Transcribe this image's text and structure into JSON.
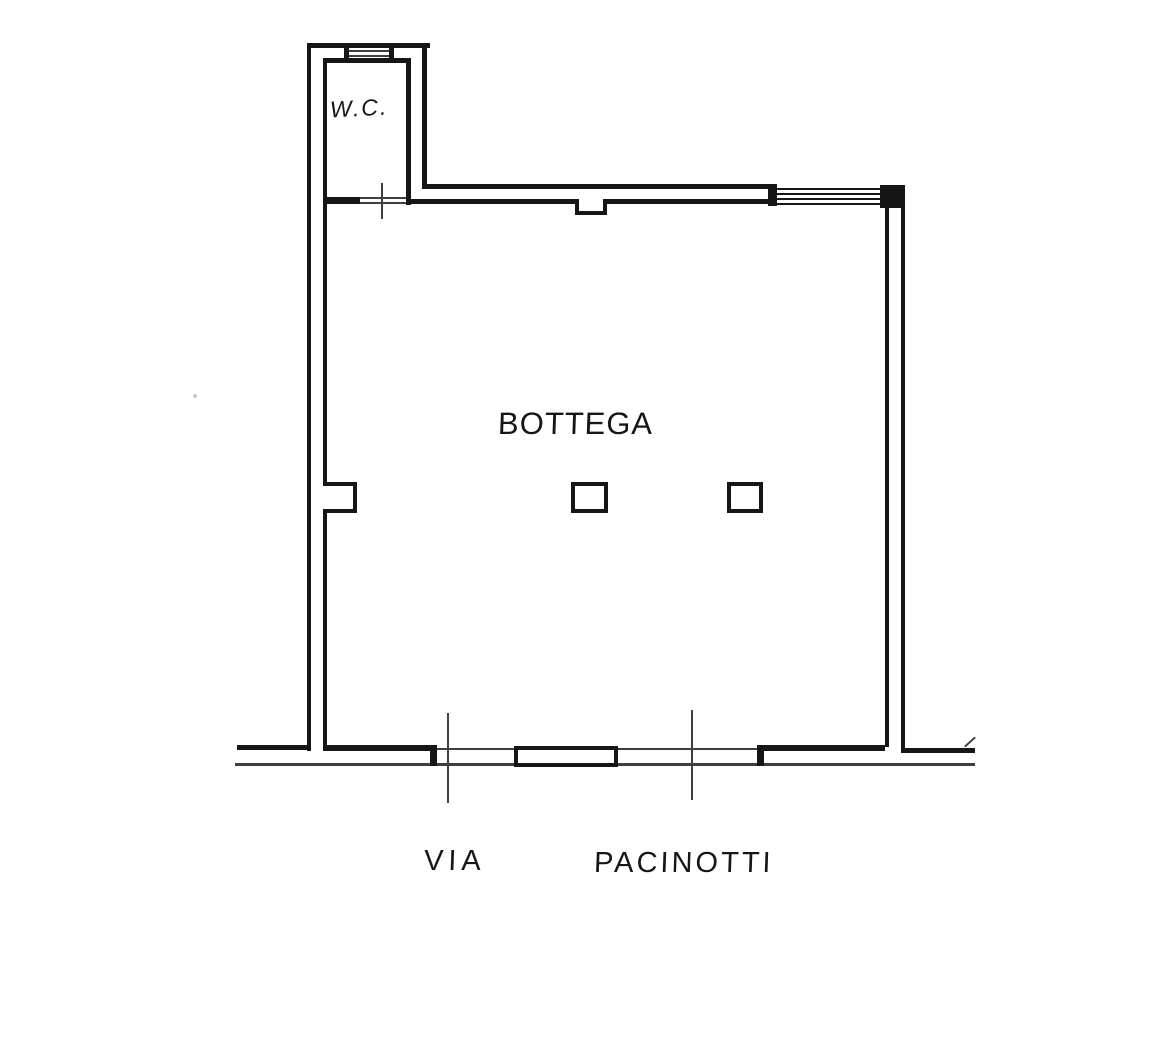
{
  "colors": {
    "ink": "#161616",
    "paper": "#ffffff"
  },
  "rooms": {
    "wc_label": "W.C.",
    "shop_label": "BOTTEGA"
  },
  "street": {
    "prefix": "VIA",
    "name": "PACINOTTI"
  }
}
